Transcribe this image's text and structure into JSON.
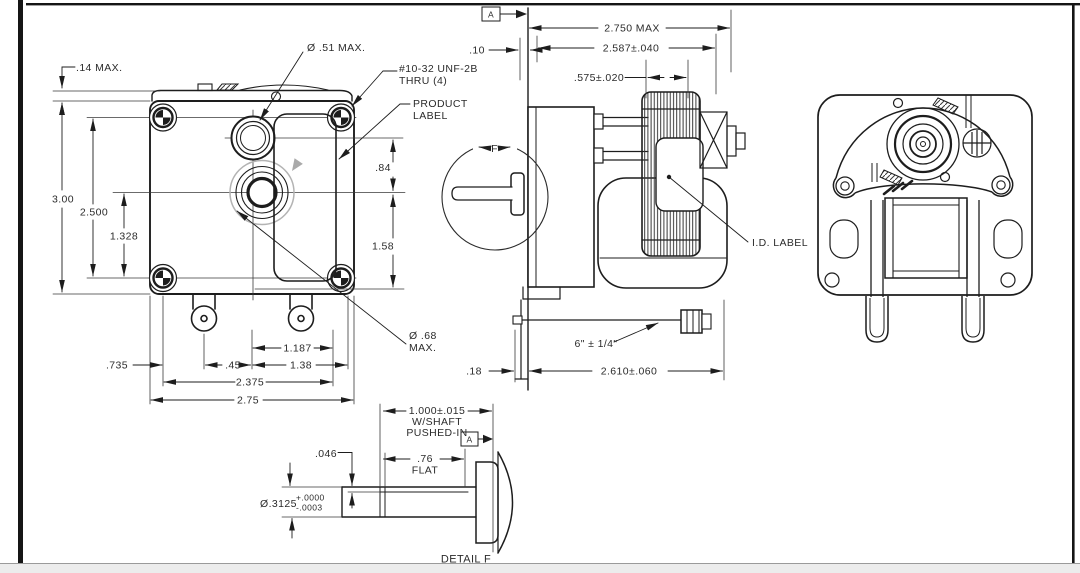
{
  "colors": {
    "line": "#1d1d1d",
    "thin_line": "#3a3a3a",
    "sheet": "#ffffff",
    "rotation_arrow_gray": "#aaaaaa",
    "chrome_bar": "#ececec"
  },
  "front": {
    "top_clearance": ".14 MAX.",
    "boss_dia": "Ø .51 MAX.",
    "thread1": "#10-32 UNF-2B",
    "thread2": "THRU (4)",
    "product1": "PRODUCT",
    "product2": "LABEL",
    "height": "3.00",
    "mount_v": "2.500",
    "shaft_v": "1.328",
    "boss_shaft": ".84",
    "shaft_bottom": "1.58",
    "hub1": "Ø .68",
    "hub2": "MAX.",
    "d735": ".735",
    "d45": ".45",
    "d1187": "1.187",
    "d138": "1.38",
    "d2375": "2.375",
    "d275": "2.75"
  },
  "side": {
    "datum": "A",
    "standoff": ".10",
    "depth_max": "2.750 MAX",
    "depth": "2.587±.040",
    "stack": ".575±.020",
    "detail_marker": "F",
    "id_label": "I.D. LABEL",
    "lead": "6\" ± 1/4\"",
    "body": "2.610±.060",
    "foot": ".18"
  },
  "detail": {
    "l1": "1.000±.015",
    "l2": "W/SHAFT",
    "l3": "PUSHED-IN",
    "datum": "A",
    "flat_depth": ".046",
    "flat1": ".76",
    "flat2": "FLAT",
    "dia": "Ø.3125",
    "tol_p": "+.0000",
    "tol_m": "-.0003",
    "caption": "DETAIL F"
  }
}
